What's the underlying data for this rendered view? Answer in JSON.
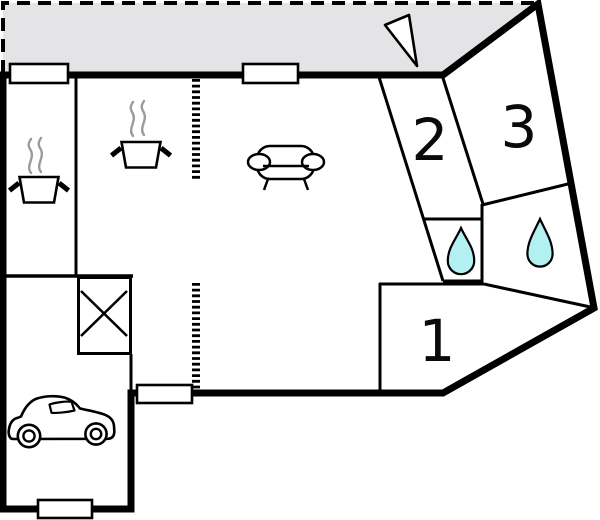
{
  "floorplan": {
    "kind": "apartment-floor-plan",
    "rooms": [
      {
        "label": "1"
      },
      {
        "label": "2"
      },
      {
        "label": "3"
      }
    ],
    "icons": [
      {
        "name": "entrance-arrow-icon",
        "count": 1
      },
      {
        "name": "cooking-pot-steam-icon",
        "count": 2
      },
      {
        "name": "sofa-icon",
        "count": 1
      },
      {
        "name": "water-drop-icon",
        "count": 2
      },
      {
        "name": "x-crossed-box-icon",
        "count": 1
      },
      {
        "name": "car-icon",
        "count": 1
      },
      {
        "name": "window-marker",
        "count": 4
      },
      {
        "name": "dashed-partition",
        "count": 2
      }
    ],
    "colors": {
      "wall": "#000000",
      "terrace_fill": "#e4e4e7",
      "water_drop_fill": "#b3f0f2",
      "steam_stroke": "#9b9b9b",
      "background": "#ffffff"
    }
  }
}
